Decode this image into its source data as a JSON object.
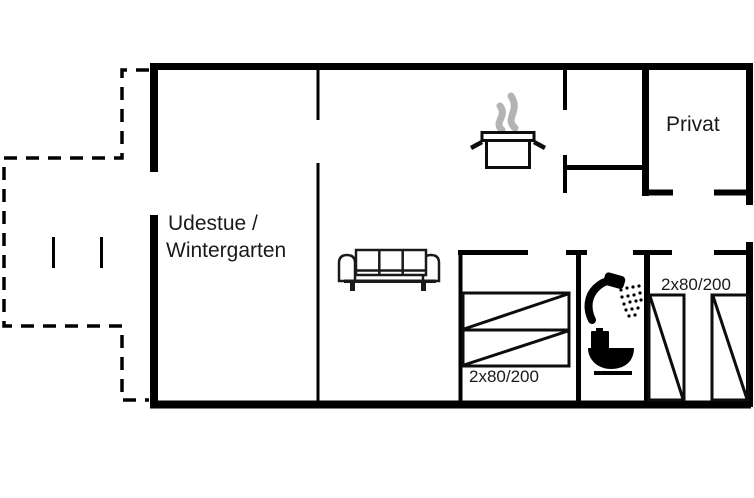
{
  "floorplan": {
    "background_color": "#ffffff",
    "wall_color": "#000000",
    "steam_color": "#b3b3b3",
    "labels": {
      "winter_garden_line1": "Udestue /",
      "winter_garden_line2": "Wintergarten",
      "private_room": "Privat",
      "double_bed_size": "2x80/200",
      "twin_bed_size": "2x80/200"
    },
    "icons": [
      {
        "name": "sofa-icon"
      },
      {
        "name": "cooking-pot-icon"
      },
      {
        "name": "steam-icon"
      },
      {
        "name": "shower-icon"
      },
      {
        "name": "toilet-icon"
      },
      {
        "name": "double-bed-icon"
      },
      {
        "name": "single-bed-icon"
      }
    ],
    "line_styles": {
      "terrace_boundary": "dashed",
      "walls": "solid"
    }
  }
}
